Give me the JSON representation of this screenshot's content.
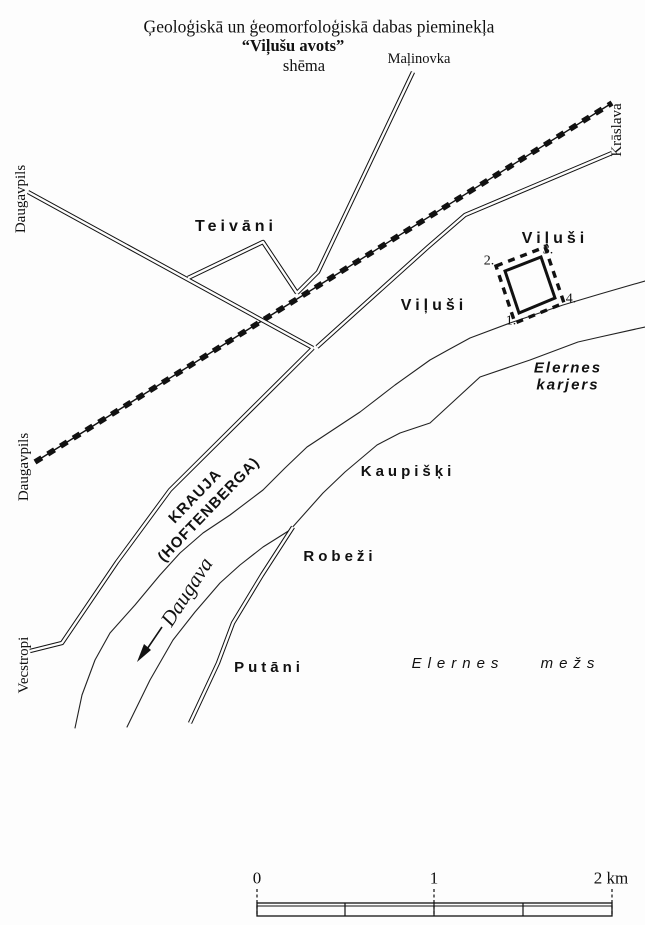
{
  "title": {
    "line1": "Ģeoloģiskā un ģeomorfoloģiskā dabas pieminekļa",
    "line2": "“Viļušu avots”",
    "line3": "shēma"
  },
  "labels": {
    "malinovka": "Maļinovka",
    "kraslava": "Krāslava",
    "daugavpils_top": "Daugavpils",
    "daugavpils_mid": "Daugavpils",
    "vecstropi": "Vecstropi",
    "teivani": "Teivāni",
    "vilusi_ne": "Viļuši",
    "vilusi_center": "Viļuši",
    "kaupiski": "Kaupišķi",
    "robezi": "Robeži",
    "putani": "Putāni",
    "elernes_karjers_line1": "Elernes",
    "elernes_karjers_line2": "karjers",
    "elernes_mezs": "Elernes mežs",
    "krauja_line1": "KRAUJA",
    "krauja_line2": "(HOFTENBERGA)",
    "daugava": "Daugava"
  },
  "monument": {
    "corner1": "1.",
    "corner2": "2.",
    "corner3": "3.",
    "corner4": "4."
  },
  "scalebar": {
    "tick0": "0",
    "tick1": "1",
    "tick2": "2 km"
  },
  "colors": {
    "ink": "#111111",
    "paper": "#fdfdfd"
  }
}
